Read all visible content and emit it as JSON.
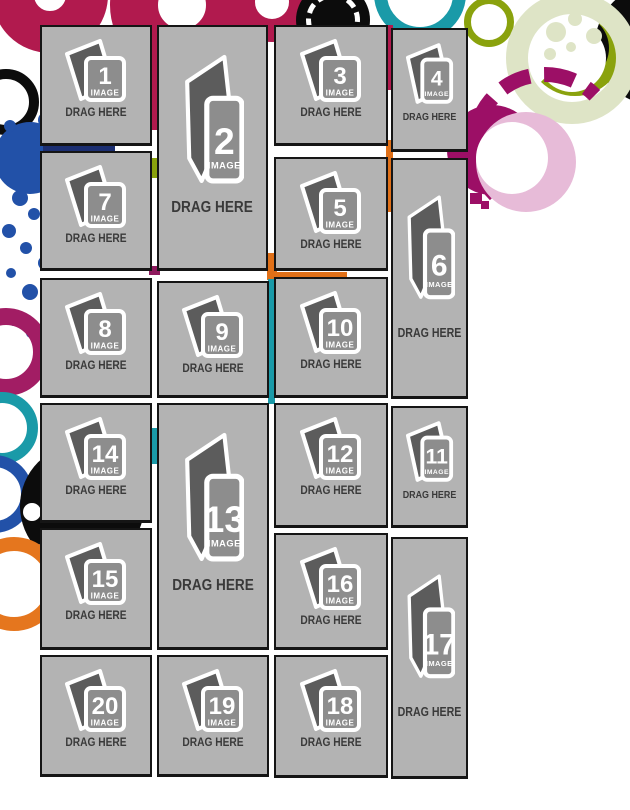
{
  "page": {
    "description": "Photo collage template with 20 numbered drag-and-drop image placeholders"
  },
  "placeholder": {
    "label": "IMAGE",
    "drop_hint": "DRAG HERE"
  },
  "slots": [
    {
      "number": "1"
    },
    {
      "number": "2"
    },
    {
      "number": "3"
    },
    {
      "number": "4"
    },
    {
      "number": "5"
    },
    {
      "number": "6"
    },
    {
      "number": "7"
    },
    {
      "number": "8"
    },
    {
      "number": "9"
    },
    {
      "number": "10"
    },
    {
      "number": "11"
    },
    {
      "number": "12"
    },
    {
      "number": "13"
    },
    {
      "number": "14"
    },
    {
      "number": "15"
    },
    {
      "number": "16"
    },
    {
      "number": "17"
    },
    {
      "number": "18"
    },
    {
      "number": "19"
    },
    {
      "number": "20"
    }
  ],
  "colors": {
    "box_fill": "#b3b3b3",
    "box_border": "#151515",
    "icon_back": "#5c5c5c",
    "icon_front": "#8d8d8d",
    "icon_outline": "#ffffff",
    "hint_text": "#3a3a3a",
    "crimson": "#b11a4e",
    "blue": "#2251a8",
    "teal": "#1a9aa8",
    "magenta": "#9c0f66",
    "pink": "#e7bbd8",
    "orange": "#e5761e",
    "olive": "#8aa20d",
    "pale_green": "#dee4c6",
    "black": "#0c0c0c"
  }
}
